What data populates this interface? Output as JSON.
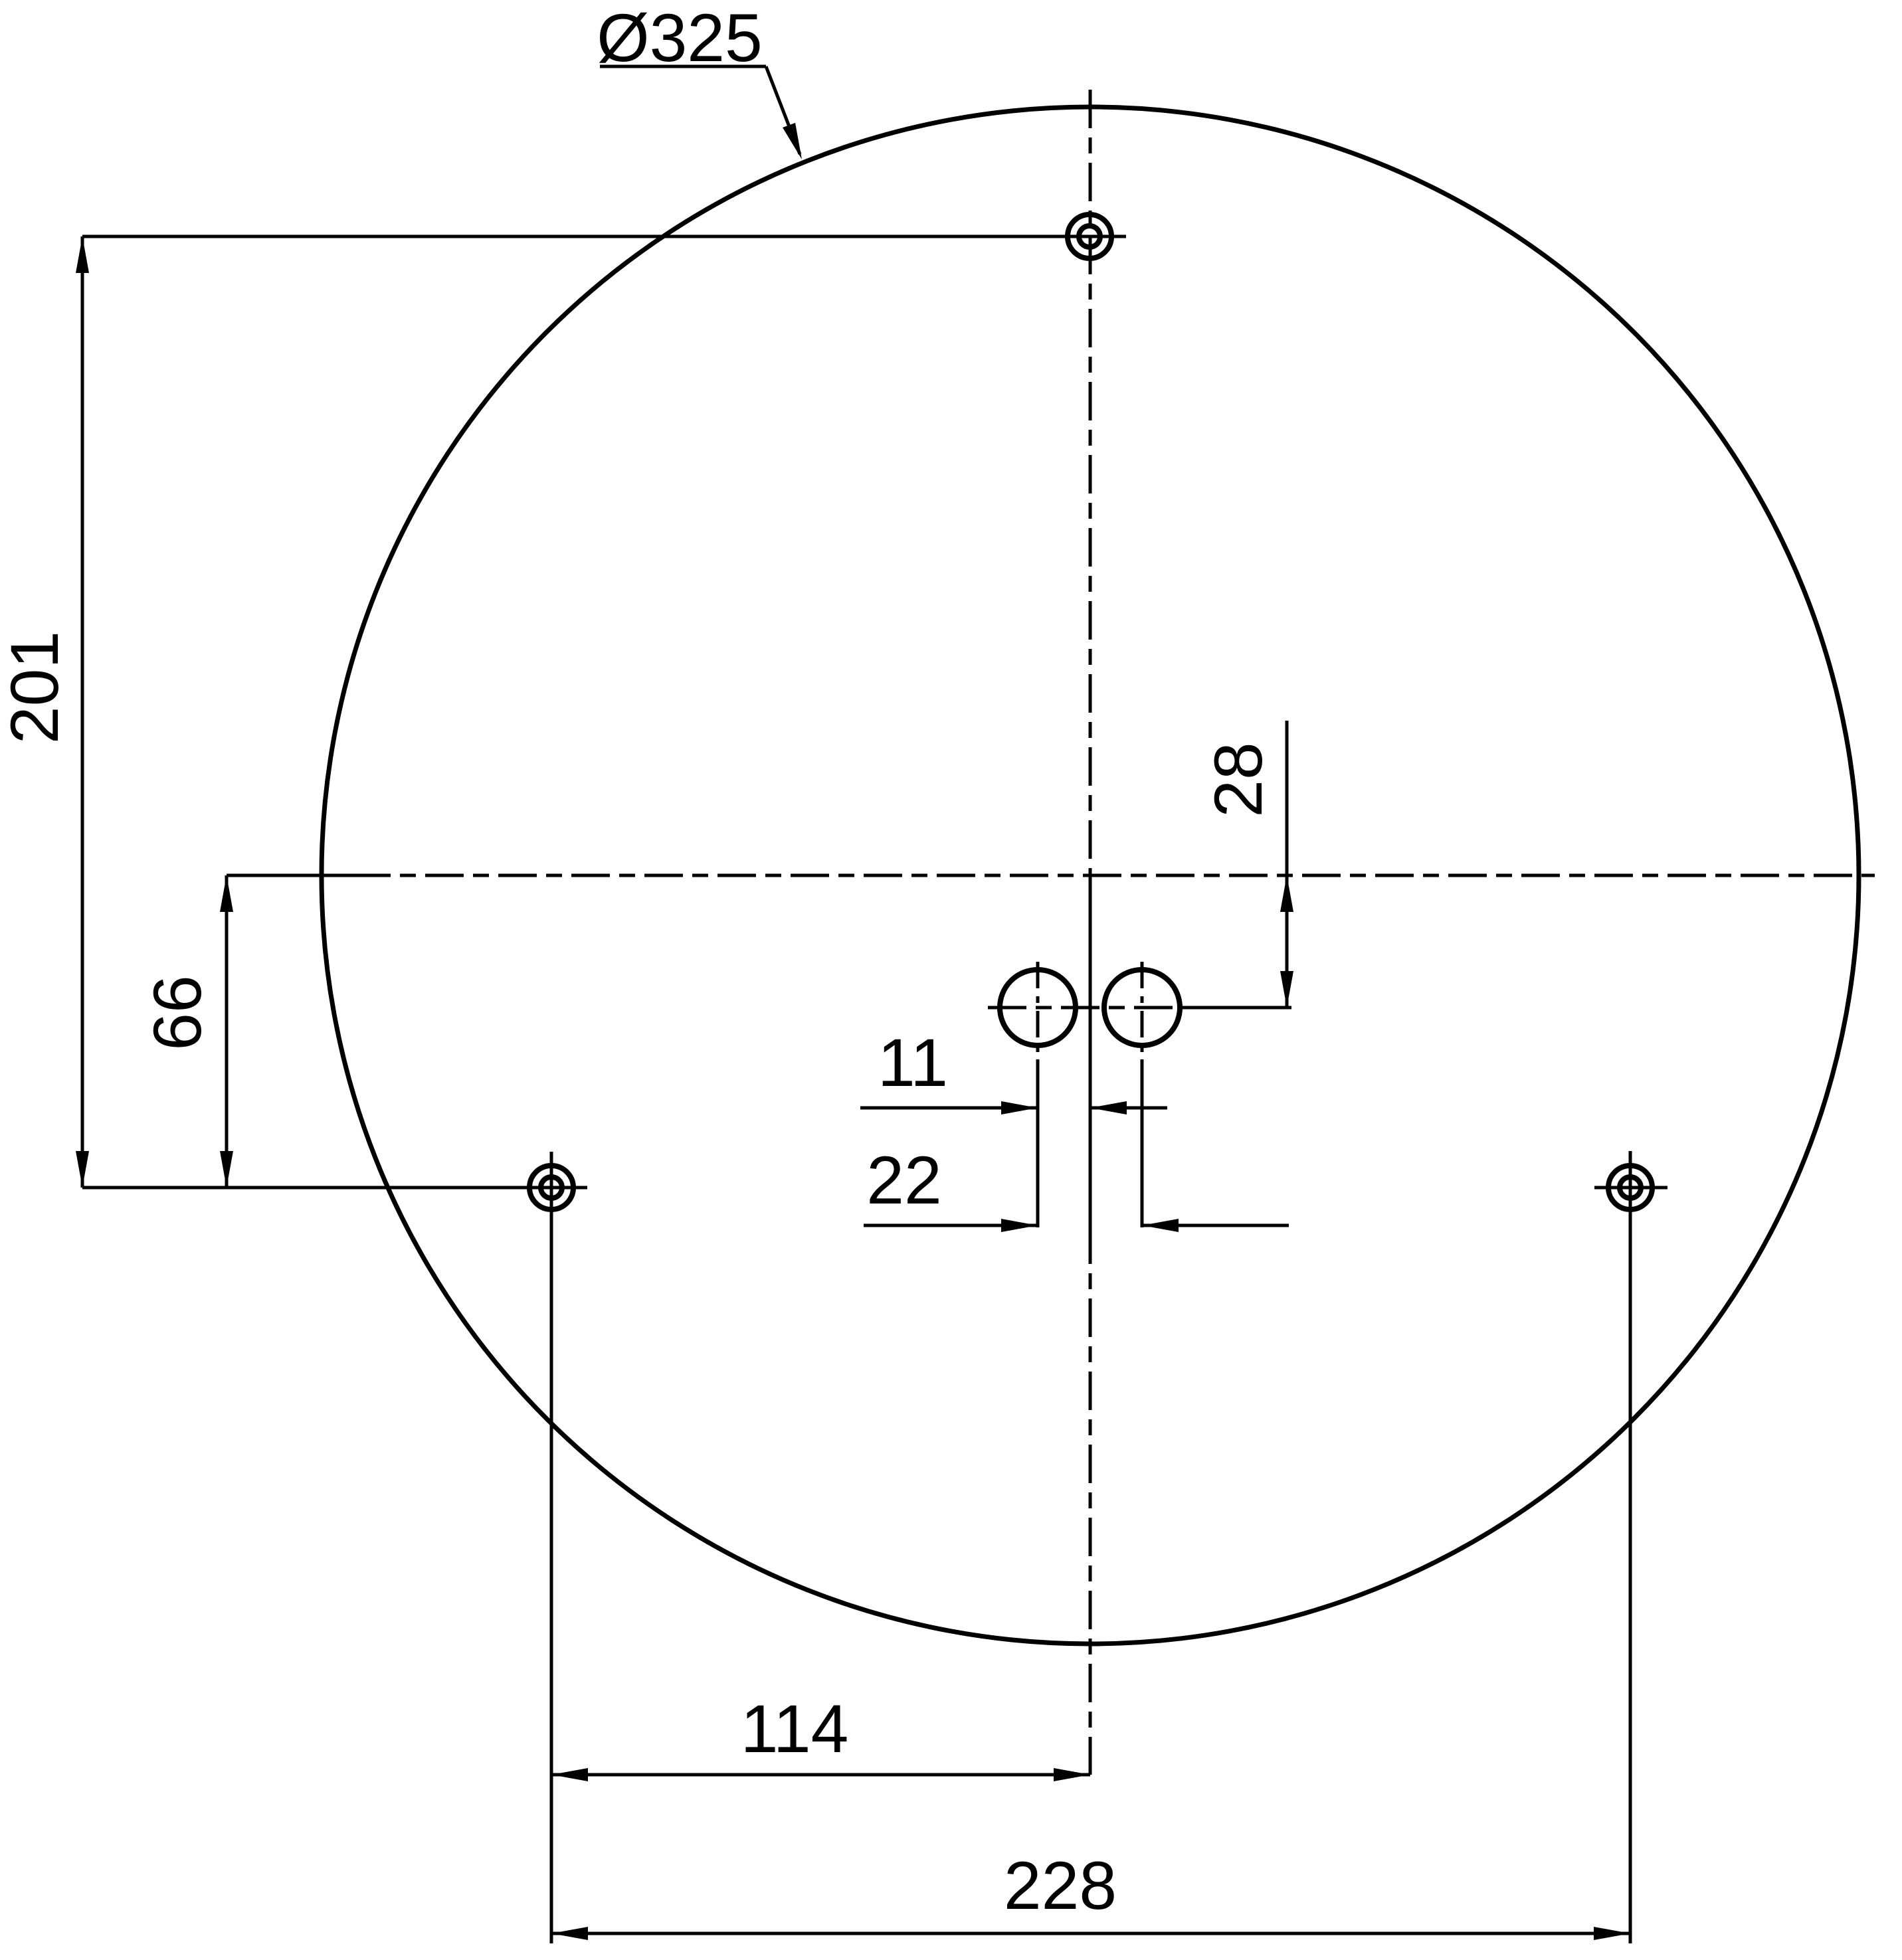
{
  "drawing": {
    "type": "technical-dimension-drawing",
    "background_color": "#ffffff",
    "line_color": "#000000",
    "diameter": {
      "label": "Ø325",
      "value": 325
    },
    "dims": {
      "d201": {
        "label": "201",
        "value": 201,
        "orientation": "vertical"
      },
      "d66": {
        "label": "66",
        "value": 66,
        "orientation": "vertical"
      },
      "d28": {
        "label": "28",
        "value": 28,
        "orientation": "vertical"
      },
      "d11": {
        "label": "11",
        "value": 11,
        "orientation": "horizontal"
      },
      "d22": {
        "label": "22",
        "value": 22,
        "orientation": "horizontal"
      },
      "d114": {
        "label": "114",
        "value": 114,
        "orientation": "horizontal"
      },
      "d228": {
        "label": "228",
        "value": 228,
        "orientation": "horizontal"
      }
    }
  }
}
